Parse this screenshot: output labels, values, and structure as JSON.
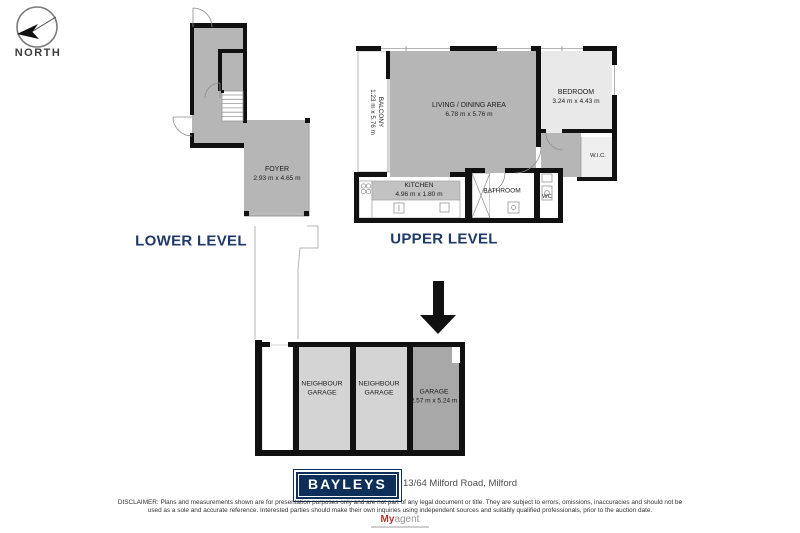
{
  "compass": {
    "label": "NORTH"
  },
  "plans": {
    "lower": {
      "title": "LOWER LEVEL",
      "foyer_name": "FOYER",
      "foyer_dims": "2.93 m x 4.65 m"
    },
    "upper": {
      "title": "UPPER LEVEL",
      "balcony_name": "BALCONY",
      "balcony_dims": "1.23 m x 5.76 m",
      "living_name": "LIVING / DINING AREA",
      "living_dims": "6.78 m x 5.76 m",
      "bedroom_name": "BEDROOM",
      "bedroom_dims": "3.24 m x 4.43 m",
      "wic_name": "W.I.C.",
      "kitchen_name": "KITCHEN",
      "kitchen_dims": "4.96 m x 1.80 m",
      "bathroom_name": "BATHROOM",
      "wc_name": "WC"
    },
    "garage": {
      "bays": [
        {
          "name": "NEIGHBOUR GARAGE"
        },
        {
          "name": "NEIGHBOUR GARAGE"
        },
        {
          "name": "GARAGE",
          "dims": "2.57 m x 5.24 m"
        }
      ]
    }
  },
  "footer": {
    "brand": "BAYLEYS",
    "address": "13/64 Milford Road, Milford",
    "disclaimer_line1": "DISCLAIMER: Plans and measurements shown are for presentation purposes only and are not part of any legal document or title. They are subject to errors, omissions, inaccuracies and should not be",
    "disclaimer_line2": "used as a sole and accurate reference. Interested parties should make their own inquiries using independent sources and suitably qualified professionals, prior to the auction date.",
    "watermark_bold": "My",
    "watermark_light": "agent"
  },
  "colors": {
    "wall": "#111111",
    "room_gray": "#b6b6b6",
    "room_light": "#e9e9e9",
    "garage_neighbour": "#d4d4d4",
    "garage_dark": "#a8a8a8",
    "level_navy": "#1f3a68",
    "brand_navy": "#0e2f5a",
    "watermark_red": "#b5372e"
  }
}
